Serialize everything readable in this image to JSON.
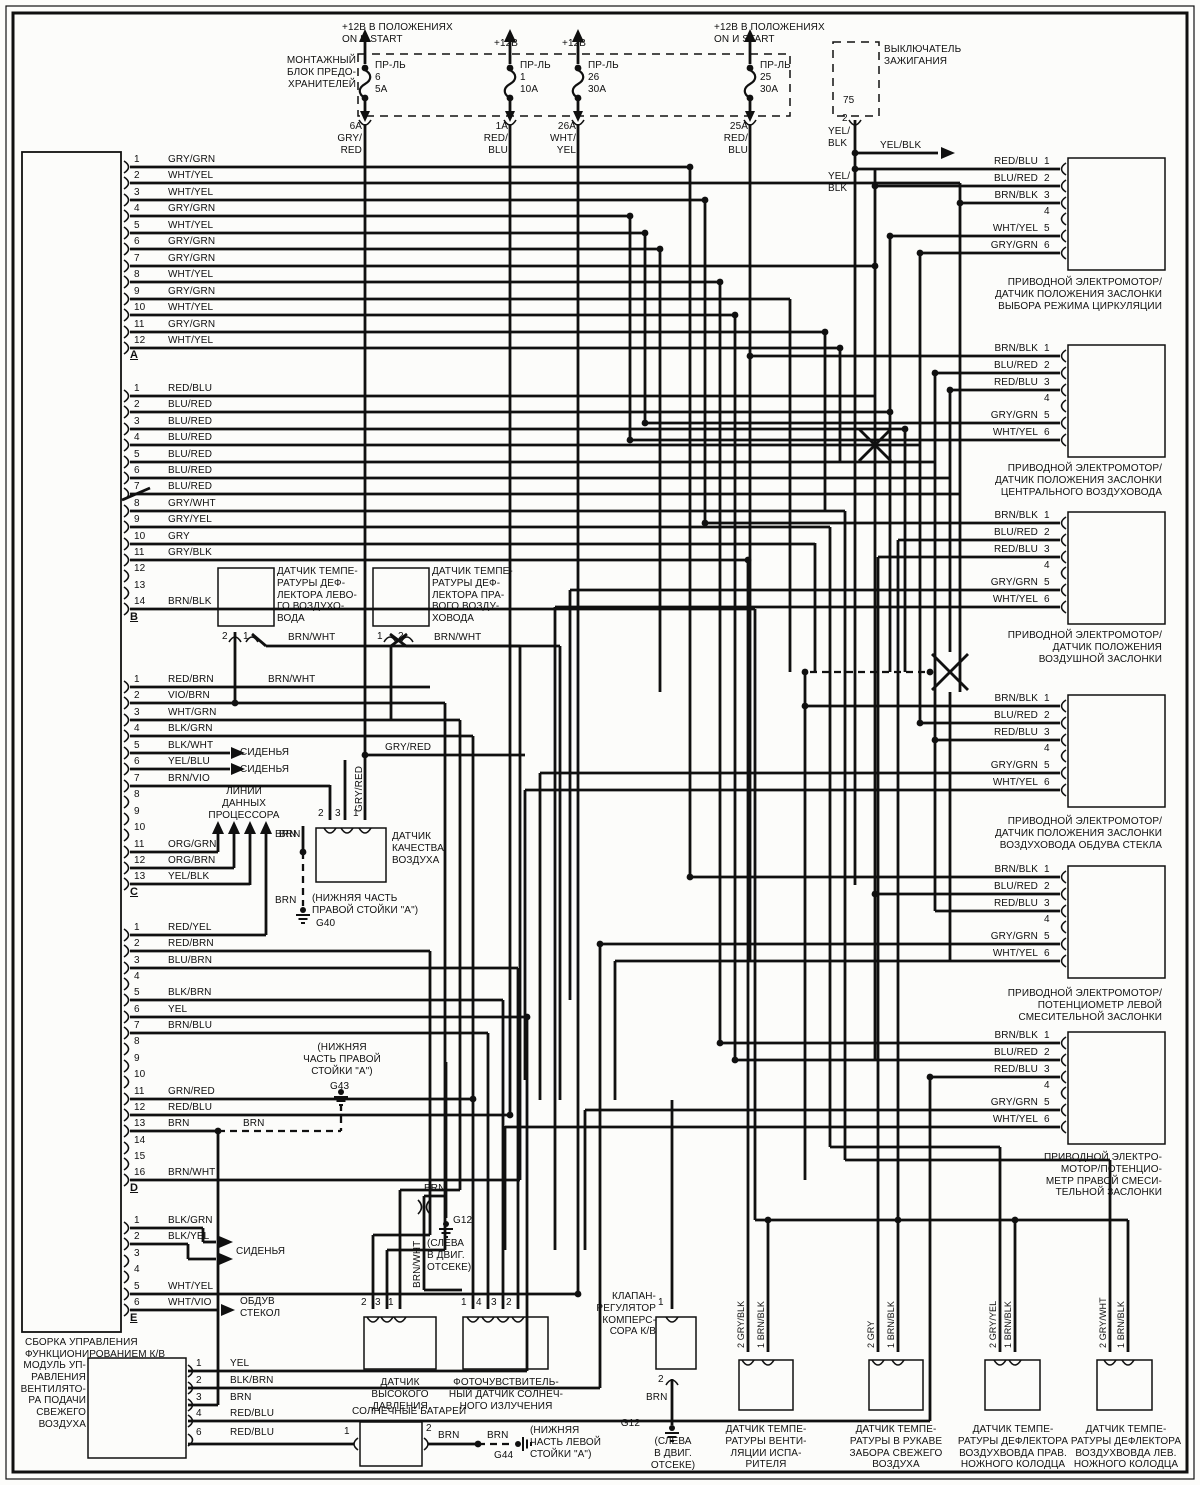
{
  "fuse_box": {
    "label": "МОНТАЖНЫЙ\nБЛОК ПРЕДО-\nХРАНИТЕЛЕЙ"
  },
  "fuses": [
    {
      "feed": "+12В В ПОЛОЖЕНИЯХ\nON И START",
      "name": "ПР-ЛЬ",
      "num": "6",
      "amp": "5А",
      "out": "6А\nGRY/\nRED"
    },
    {
      "feed": "+12В",
      "name": "ПР-ЛЬ",
      "num": "1",
      "amp": "10А",
      "out": "1А\nRED/\nBLU"
    },
    {
      "feed": "+12В",
      "name": "ПР-ЛЬ",
      "num": "26",
      "amp": "30А",
      "out": "26А\nWHT/\nYEL"
    },
    {
      "feed": "+12В В ПОЛОЖЕНИЯХ\nON И START",
      "name": "ПР-ЛЬ",
      "num": "25",
      "amp": "30А",
      "out": "25А\nRED/\nBLU"
    }
  ],
  "ignition": {
    "label": "ВЫКЛЮЧАТЕЛЬ\nЗАЖИГАНИЯ",
    "terminal": "75",
    "pin": "2"
  },
  "main_module": {
    "label": "СБОРКА УПРАВЛЕНИЯ\nФУНКЦИОНИРОВАНИЕМ К/В",
    "groups": [
      {
        "id": "A",
        "pins": [
          "GRY/GRN",
          "WHT/YEL",
          "WHT/YEL",
          "GRY/GRN",
          "WHT/YEL",
          "GRY/GRN",
          "GRY/GRN",
          "WHT/YEL",
          "GRY/GRN",
          "WHT/YEL",
          "GRY/GRN",
          "WHT/YEL"
        ]
      },
      {
        "id": "B",
        "pins": [
          "RED/BLU",
          "BLU/RED",
          "BLU/RED",
          "BLU/RED",
          "BLU/RED",
          "BLU/RED",
          "BLU/RED",
          "GRY/WHT",
          "GRY/YEL",
          "GRY",
          "GRY/BLK",
          "",
          "",
          "BRN/BLK"
        ]
      },
      {
        "id": "C",
        "pins": [
          "RED/BRN",
          "VIO/BRN",
          "WHT/GRN",
          "BLK/GRN",
          "BLK/WHT",
          "YEL/BLU",
          "BRN/VIO",
          "",
          "",
          "",
          "ORG/GRN",
          "ORG/BRN",
          "YEL/BLK"
        ]
      },
      {
        "id": "D",
        "pins": [
          "RED/YEL",
          "RED/BRN",
          "BLU/BRN",
          "",
          "BLK/BRN",
          "YEL",
          "BRN/BLU",
          "",
          "",
          "",
          "GR N/RED",
          "RED/BLU",
          "BRN",
          "",
          "",
          "BRN/WHT"
        ]
      },
      {
        "id": "E",
        "pins": [
          "BLK/GRN",
          "BLK/YEL",
          "",
          "",
          "WHT/YEL",
          "WHT/VIO"
        ]
      }
    ]
  },
  "fan_module": {
    "label": "МОДУЛЬ УП-\nРАВЛЕНИЯ\nВЕНТИЛЯТО-\nРА ПОДАЧИ\nСВЕЖЕГО\nВОЗДУХА",
    "pins": [
      {
        "n": "1",
        "w": "YEL"
      },
      {
        "n": "2",
        "w": "BLK/BRN"
      },
      {
        "n": "3",
        "w": "BRN"
      },
      {
        "n": "4",
        "w": "RED/BLU"
      },
      {
        "n": "6",
        "w": "RED/BLU"
      }
    ]
  },
  "connectors": [
    {
      "label": "ПРИВОДНОЙ ЭЛЕКТРОМОТОР/\nДАТЧИК ПОЛОЖЕНИЯ ЗАСЛОНКИ\nВЫБОРА РЕЖИМА ЦИРКУЛЯЦИИ",
      "pins": [
        "RED/BLU",
        "BLU/RED",
        "BRN/BLK",
        "",
        "WHT/YEL",
        "GRY/GRN"
      ]
    },
    {
      "label": "ПРИВОДНОЙ ЭЛЕКТРОМОТОР/\nДАТЧИК ПОЛОЖЕНИЯ ЗАСЛОНКИ\nЦЕНТРАЛЬНОГО ВОЗДУХОВОДА",
      "pins": [
        "BRN/BLK",
        "BLU/RED",
        "RED/BLU",
        "",
        "GRY/GRN",
        "WHT/YEL"
      ]
    },
    {
      "label": "ПРИВОДНОЙ ЭЛЕКТРОМОТОР/\nДАТЧИК ПОЛОЖЕНИЯ\nВОЗДУШНОЙ ЗАСЛОНКИ",
      "pins": [
        "BRN/BLK",
        "BLU/RED",
        "RED/BLU",
        "",
        "GRY/GRN",
        "WHT/YEL"
      ]
    },
    {
      "label": "ПРИВОДНОЙ ЭЛЕКТРОМОТОР/\nДАТЧИК ПОЛОЖЕНИЯ ЗАСЛОНКИ\nВОЗДУХОВОДА ОБДУВА СТЕКЛА",
      "pins": [
        "BRN/BLK",
        "BLU/RED",
        "RED/BLU",
        "",
        "GRY/GRN",
        "WHT/YEL"
      ]
    },
    {
      "label": "ПРИВОДНОЙ ЭЛЕКТРОМОТОР/\nПОТЕНЦИОМЕТР ЛЕВОЙ\nСМЕСИТЕЛЬНОЙ ЗАСЛОНКИ",
      "pins": [
        "BRN/BLK",
        "BLU/RED",
        "RED/BLU",
        "",
        "GRY/GRN",
        "WHT/YEL"
      ]
    },
    {
      "label": "ПРИВОДНОЙ ЭЛЕКТРО-\nМОТОР/ПОТЕНЦИО-\nМЕТР ПРАВОЙ СМЕСИ-\nТЕЛЬНОЙ ЗАСЛОНКИ",
      "pins": [
        "BRN/BLK",
        "BLU/RED",
        "RED/BLU",
        "",
        "GRY/GRN",
        "WHT/YEL"
      ]
    }
  ],
  "components": {
    "left_defl": {
      "label": "ДАТЧИК ТЕМПЕ-\nРАТУРЫ ДЕФ-\nЛЕКТОРА ЛЕВО-\nГО ВОЗДУХО-\nВОДА",
      "pins": [
        "2",
        "1"
      ]
    },
    "right_defl": {
      "label": "ДАТЧИК ТЕМПЕ-\nРАТУРЫ ДЕФ-\nЛЕКТОРА ПРА-\nВОГО ВОЗДУ-\nХОВОДА",
      "pins": [
        "1",
        "2"
      ]
    },
    "air_quality": {
      "label": "ДАТЧИК\nКАЧЕСТВА\nВОЗДУХА",
      "pins": [
        "2",
        "3",
        "1"
      ]
    },
    "pressure": {
      "label": "ДАТЧИК\nВЫСОКОГО\nДАВЛЕНИЯ",
      "pins": [
        "2",
        "3",
        "1"
      ]
    },
    "photo": {
      "label": "ФОТОЧУВСТВИТЕЛЬ-\nНЫЙ ДАТЧИК СОЛНЕЧ-\nНОГО ИЗЛУЧЕНИЯ",
      "pins": [
        "1",
        "4",
        "3",
        "2"
      ]
    },
    "valve": {
      "label": "КЛАПАН-\nРЕГУЛЯТОР\nКОМПЕРС-\nСОРА К/В",
      "pin_top": "1",
      "pin_bottom": "2"
    },
    "evap": {
      "label": "ДАТЧИК ТЕМПЕ-\nРАТУРЫ ВЕНТИ-\nЛЯЦИИ  ИСПА-\nРИТЕЛЯ",
      "w1": "2 GRY/BLK",
      "w2": "1 BRN/BLK"
    },
    "fresh": {
      "label": "ДАТЧИК ТЕМПЕ-\nРАТУРЫ В РУКАВЕ\nЗАБОРА СВЕЖЕГО\nВОЗДУХА",
      "w1": "2 GRY",
      "w2": "1 BRN/BLK"
    },
    "rfoot": {
      "label": "ДАТЧИК ТЕМПЕ-\nРАТУРЫ ДЕФЛЕКТОРА\nВОЗДУХВОВДА ПРАВ.\nНОЖНОГО КОЛОДЦА",
      "w1": "2 GRY/YEL",
      "w2": "1 BRN/BLK"
    },
    "lfoot": {
      "label": "ДАТЧИК ТЕМПЕ-\nРАТУРЫ ДЕФЛЕКТОРА\nВОЗДУХВОВДА ЛЕВ.\nНОЖНОГО КОЛОДЦА",
      "w1": "2 GRY/WHT",
      "w2": "1 BRN/BLK"
    },
    "solar": {
      "label": "СОЛНЕЧНЫЕ БАТАРЕИ",
      "pins": [
        "1",
        "2"
      ]
    }
  },
  "grounds": {
    "g40": {
      "id": "G40",
      "note": "(НИЖНЯЯ ЧАСТЬ\nПРАВОЙ СТОЙКИ  \"А\")"
    },
    "g43": {
      "id": "G43",
      "note": "(НИЖНЯЯ\nЧАСТЬ ПРАВОЙ\nСТОЙКИ  \"А\")"
    },
    "g12t": {
      "id": "G12",
      "note": "(СЛЕВА\nВ ДВИГ.\nОТСЕКЕ)"
    },
    "g12b": {
      "id": "G12",
      "note": "(СЛЕВА\nВ ДВИГ.\nОТСЕКЕ)"
    },
    "g44": {
      "id": "G44",
      "note": "(НИЖНЯЯ\nЧАСТЬ ЛЕВОЙ\nСТОЙКИ  \"А\")"
    }
  },
  "arrows": {
    "seats": "СИДЕНЬЯ",
    "defrost": "ОБДУВ\nСТЕКОЛ",
    "data_lines": "ЛИНИИ\nДАННЫХ\nПРОЦЕССОРА"
  },
  "wires": {
    "brn_wht": "BRN/WHT",
    "gry_red": "GRY/RED",
    "brn": "BRN",
    "yel_blk": "YEL/BLK",
    "yel_blk2": "YEL/\nBLK"
  }
}
